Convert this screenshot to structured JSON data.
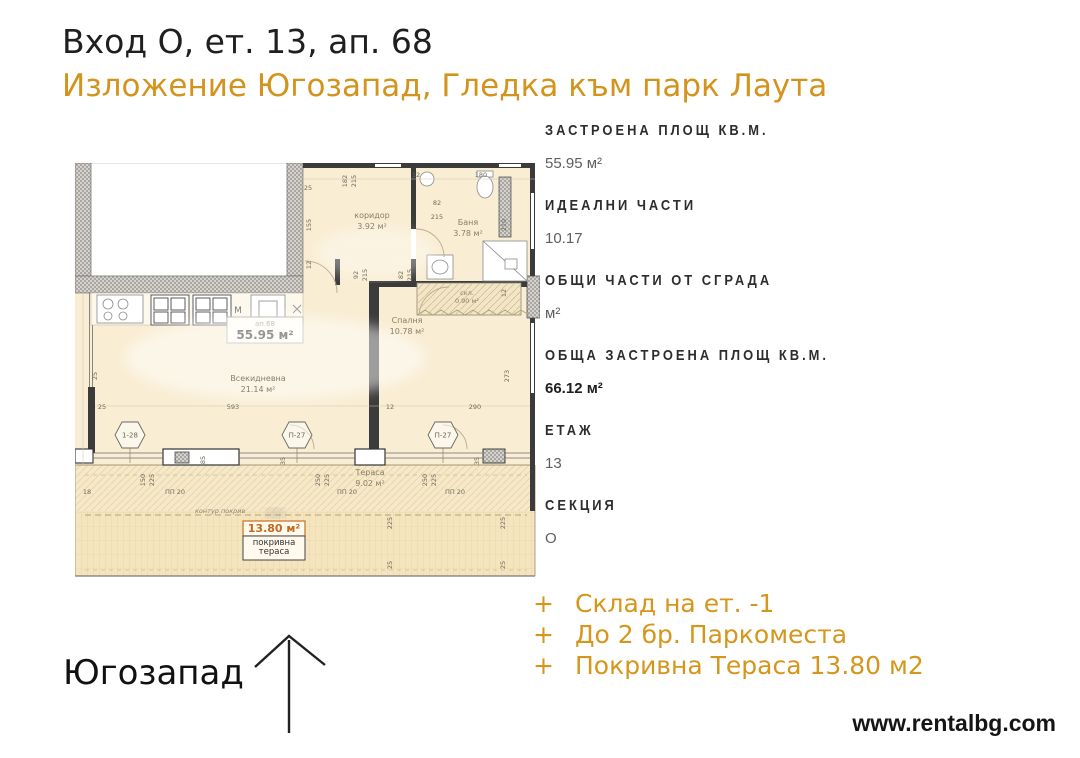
{
  "header": {
    "title": "Вход О, ет. 13, ап. 68",
    "subtitle": "Изложение Югозапад, Гледка към парк Лаута"
  },
  "colors": {
    "accent": "#D2941C",
    "text": "#1f1f1f",
    "plan_fill": "#f8ecd1",
    "terrace_fill": "#f5e5bf"
  },
  "details": [
    {
      "label": "ЗАСТРОЕНА ПЛОЩ КВ.М.",
      "value": "55.95 м²",
      "bold": false
    },
    {
      "label": "ИДЕАЛНИ ЧАСТИ",
      "value": "10.17",
      "bold": false
    },
    {
      "label": "ОБЩИ ЧАСТИ ОТ СГРАДА",
      "value": "м²",
      "bold": false
    },
    {
      "label": "ОБЩА ЗАСТРОЕНА ПЛОЩ КВ.М.",
      "value": "66.12 м²",
      "bold": true
    },
    {
      "label": "ЕТАЖ",
      "value": "13",
      "bold": false
    },
    {
      "label": "СЕКЦИЯ",
      "value": "О",
      "bold": false
    }
  ],
  "extras": {
    "bullet": "+",
    "items": [
      "Склад на ет. -1",
      "До 2 бр. Паркоместа",
      "Покривна Тераса 13.80 м2"
    ]
  },
  "compass": {
    "label": "Югозапад",
    "direction": "up"
  },
  "footer": {
    "website": "www.rentalbg.com"
  },
  "floorplan": {
    "unit_label": {
      "top": "ап.68",
      "area": "55.95 м²"
    },
    "kitchen_letter": "М",
    "note": "контур покрив",
    "roof_terrace": {
      "area": "13.80 м²",
      "name_line1": "покривна",
      "name_line2": "тераса"
    },
    "rooms": [
      {
        "name": "коридор",
        "area": "3.92 м²",
        "x": 297,
        "y": 55
      },
      {
        "name": "Баня",
        "area": "3.78 м²",
        "x": 393,
        "y": 62
      },
      {
        "name": "скл.",
        "area": "0.90 м²",
        "x": 392,
        "y": 132,
        "small": true
      },
      {
        "name": "Спалня",
        "area": "10.78 м²",
        "x": 332,
        "y": 160
      },
      {
        "name": "Всекидневна",
        "area": "21.14 м²",
        "x": 183,
        "y": 218
      },
      {
        "name": "Тераса",
        "area": "9.02 м²",
        "x": 295,
        "y": 312
      }
    ],
    "markers": [
      {
        "t": "1-28",
        "x": 55,
        "y": 272
      },
      {
        "t": "П-27",
        "x": 222,
        "y": 272
      },
      {
        "t": "П-27",
        "x": 368,
        "y": 272
      }
    ],
    "dimensions": [
      {
        "t": "25",
        "x": 233,
        "y": 27
      },
      {
        "t": "182",
        "x": 272,
        "y": 18,
        "r": -90
      },
      {
        "t": "215",
        "x": 281,
        "y": 18,
        "r": -90
      },
      {
        "t": "12",
        "x": 341,
        "y": 14
      },
      {
        "t": "180",
        "x": 406,
        "y": 14
      },
      {
        "t": "82",
        "x": 362,
        "y": 42
      },
      {
        "t": "215",
        "x": 362,
        "y": 56
      },
      {
        "t": "155",
        "x": 236,
        "y": 62,
        "r": -90
      },
      {
        "t": "12",
        "x": 236,
        "y": 102,
        "r": -90
      },
      {
        "t": "92",
        "x": 283,
        "y": 112,
        "r": -90
      },
      {
        "t": "215",
        "x": 292,
        "y": 112,
        "r": -90
      },
      {
        "t": "82",
        "x": 328,
        "y": 112,
        "r": -90
      },
      {
        "t": "215",
        "x": 337,
        "y": 112,
        "r": -90
      },
      {
        "t": "210",
        "x": 431,
        "y": 62,
        "r": -90
      },
      {
        "t": "12",
        "x": 431,
        "y": 130,
        "r": -90
      },
      {
        "t": "25",
        "x": 22,
        "y": 213,
        "r": -90
      },
      {
        "t": "25",
        "x": 27,
        "y": 246
      },
      {
        "t": "593",
        "x": 158,
        "y": 246
      },
      {
        "t": "12",
        "x": 315,
        "y": 246
      },
      {
        "t": "290",
        "x": 400,
        "y": 246
      },
      {
        "t": "273",
        "x": 434,
        "y": 213,
        "r": -90
      },
      {
        "t": "85",
        "x": 130,
        "y": 297,
        "r": -90
      },
      {
        "t": "35",
        "x": 210,
        "y": 298,
        "r": -90
      },
      {
        "t": "35",
        "x": 404,
        "y": 298,
        "r": -90
      },
      {
        "t": "18",
        "x": 12,
        "y": 331
      },
      {
        "t": "150",
        "x": 70,
        "y": 317,
        "r": -90
      },
      {
        "t": "225",
        "x": 79,
        "y": 317,
        "r": -90
      },
      {
        "t": "ПП 20",
        "x": 100,
        "y": 331
      },
      {
        "t": "250",
        "x": 245,
        "y": 317,
        "r": -90
      },
      {
        "t": "225",
        "x": 254,
        "y": 317,
        "r": -90
      },
      {
        "t": "ПП 20",
        "x": 272,
        "y": 331
      },
      {
        "t": "250",
        "x": 352,
        "y": 317,
        "r": -90
      },
      {
        "t": "225",
        "x": 361,
        "y": 317,
        "r": -90
      },
      {
        "t": "ПП 20",
        "x": 380,
        "y": 331
      },
      {
        "t": "225",
        "x": 317,
        "y": 360,
        "r": -90
      },
      {
        "t": "225",
        "x": 430,
        "y": 360,
        "r": -90
      },
      {
        "t": "25",
        "x": 317,
        "y": 402,
        "r": -90
      },
      {
        "t": "25",
        "x": 430,
        "y": 402,
        "r": -90
      }
    ]
  }
}
